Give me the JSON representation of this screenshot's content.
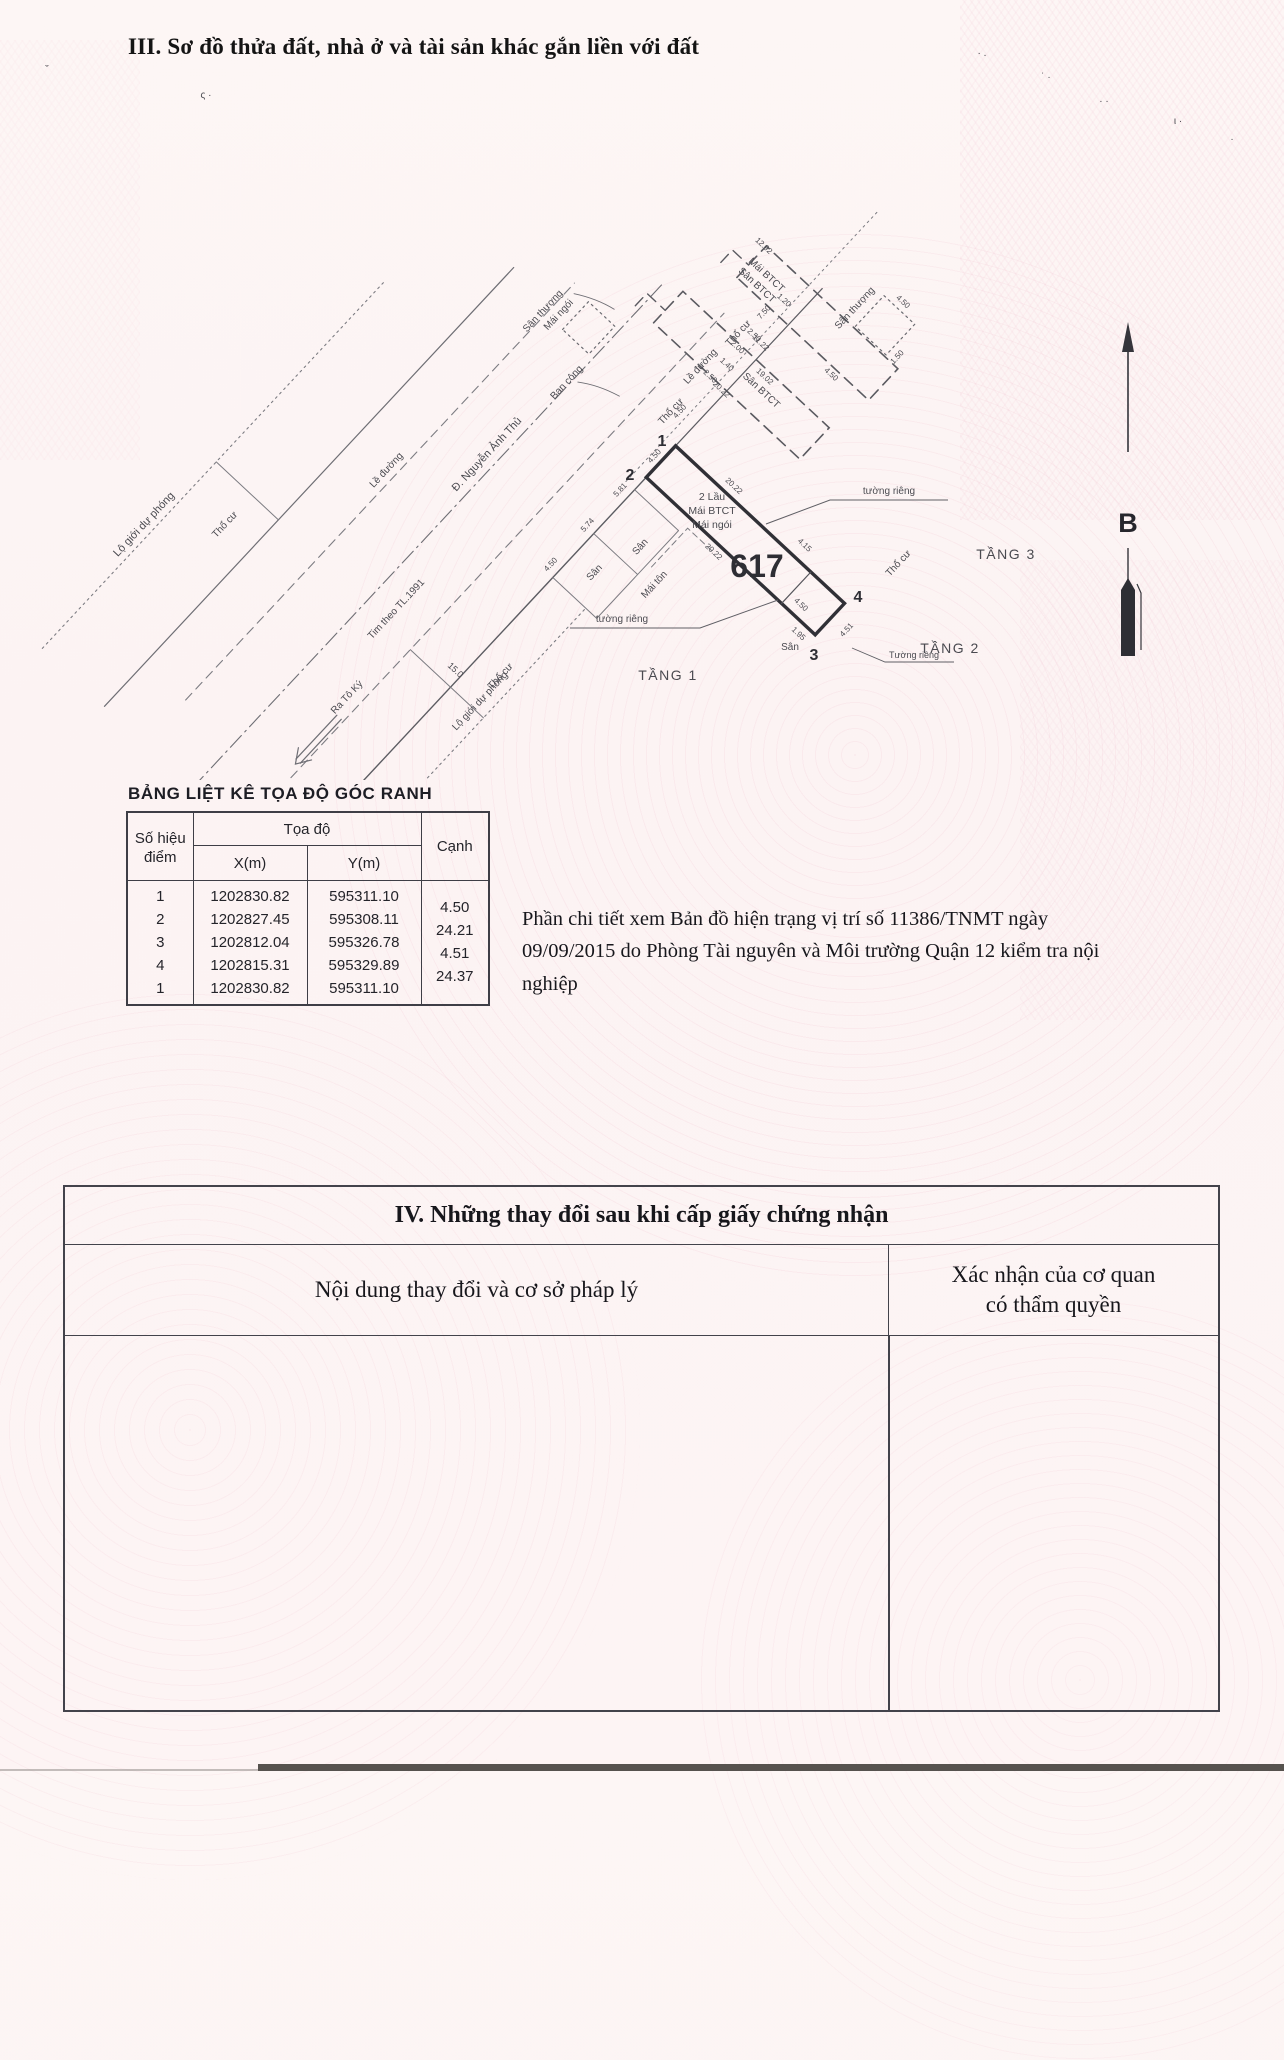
{
  "page": {
    "section3_title": "III. Sơ đồ thửa đất, nhà ở và tài sản khác gắn liền với đất",
    "note_paragraph": "Phần chi tiết xem Bản đồ hiện trạng vị trí số 11386/TNMT ngày 09/09/2015 do Phòng Tài nguyên và Môi trường Quận 12 kiểm tra nội nghiệp"
  },
  "coord_table": {
    "title": "BẢNG LIỆT KÊ TỌA ĐỘ GÓC RANH",
    "col_point_line1": "Số hiệu",
    "col_point_line2": "điểm",
    "col_coords": "Tọa độ",
    "col_x": "X(m)",
    "col_y": "Y(m)",
    "col_edge": "Cạnh",
    "rows": [
      [
        "1",
        "1202830.82",
        "595311.10"
      ],
      [
        "2",
        "1202827.45",
        "595308.11"
      ],
      [
        "3",
        "1202812.04",
        "595326.78"
      ],
      [
        "4",
        "1202815.31",
        "595329.89"
      ],
      [
        "1",
        "1202830.82",
        "595311.10"
      ]
    ],
    "edges": [
      "4.50",
      "24.21",
      "4.51",
      "24.37"
    ]
  },
  "section4": {
    "title": "IV. Những thay đổi sau khi cấp giấy chứng nhận",
    "col_left": "Nội dung thay đổi và cơ sở pháp lý",
    "col_right_line1": "Xác nhận của cơ quan",
    "col_right_line2": "có thẩm quyền"
  },
  "compass": {
    "label": "B"
  },
  "diagram": {
    "plot_number": "617",
    "labels": [
      {
        "t": "Lộ giới dự phóng",
        "x": -400,
        "y": -302,
        "s": 11,
        "n": "street-label-lo-gioi-du-phong"
      },
      {
        "t": "Thổ cư",
        "x": -345,
        "y": -243,
        "s": 10
      },
      {
        "t": "Lề đường",
        "x": -195,
        "y": -162,
        "s": 10
      },
      {
        "t": "Đ. Nguyễn Ảnh Thủ",
        "x": -115,
        "y": -99,
        "s": 11,
        "n": "street-name-label"
      },
      {
        "t": "Tim theo TL.1991",
        "x": -290,
        "y": -60,
        "s": 10
      },
      {
        "t": "Ra Tô Ký",
        "x": -388,
        "y": -36,
        "s": 10
      },
      {
        "t": "Lề đường",
        "x": 95,
        "y": -3,
        "s": 10
      },
      {
        "t": "Lộ giới dự phóng",
        "x": -300,
        "y": 64,
        "s": 10,
        "n": "street-label-lo-gioi-du-phong"
      },
      {
        "t": "15.0",
        "x": -297,
        "y": 22,
        "r": 90,
        "s": 9
      },
      {
        "t": "Thổ cư",
        "x": -268,
        "y": 62,
        "s": 10
      },
      {
        "t": "Sân",
        "x": -128,
        "y": 60,
        "s": 10
      },
      {
        "t": "Sân",
        "x": -78,
        "y": 76,
        "s": 10
      },
      {
        "t": "Mái tôn",
        "x": -96,
        "y": 112,
        "s": 10
      },
      {
        "t": "Thổ cư",
        "x": 42,
        "y": 6,
        "s": 10
      },
      {
        "t": "Thổ cư",
        "x": 145,
        "y": 2,
        "s": 10
      },
      {
        "t": "Thổ cư",
        "x": 86,
        "y": 276,
        "s": 10
      },
      {
        "t": "4.50",
        "x": -152,
        "y": 22,
        "s": 8
      },
      {
        "t": "5.74",
        "x": -98,
        "y": 22,
        "s": 8
      },
      {
        "t": "5.81",
        "x": -50,
        "y": 22,
        "s": 8
      },
      {
        "t": "4.50",
        "x": -2,
        "y": 24,
        "s": 8
      },
      {
        "t": "20.22",
        "x": -34,
        "y": 130,
        "r": 90,
        "s": 8
      },
      {
        "t": "20.22",
        "x": 28,
        "y": 100,
        "r": 90,
        "s": 8
      },
      {
        "t": "4.15",
        "x": 33,
        "y": 192,
        "r": 90,
        "s": 8
      },
      {
        "t": "4.50",
        "x": -13,
        "y": 230,
        "r": 90,
        "s": 8
      },
      {
        "t": "1.95",
        "x": -36,
        "y": 248,
        "r": 90,
        "s": 8
      },
      {
        "t": "4.51",
        "x": 2,
        "y": 283,
        "s": 8
      },
      {
        "t": "4.50",
        "x": 48,
        "y": 12,
        "s": 8
      },
      {
        "t": "2.50",
        "x": 92,
        "y": 8,
        "r": 90,
        "s": 8
      },
      {
        "t": "1.40",
        "x": 112,
        "y": 12,
        "r": 90,
        "s": 8
      },
      {
        "t": "2.00",
        "x": 132,
        "y": 8,
        "r": 90,
        "s": 8
      },
      {
        "t": "2.50",
        "x": 152,
        "y": 12,
        "r": 90,
        "s": 8
      },
      {
        "t": "7.50",
        "x": 178,
        "y": 6,
        "s": 8
      },
      {
        "t": "1.20",
        "x": 198,
        "y": 10,
        "r": 90,
        "s": 8
      },
      {
        "t": "Sân BTCT",
        "x": 116,
        "y": 55,
        "r": 90,
        "s": 10
      },
      {
        "t": "20.22",
        "x": 90,
        "y": 25,
        "r": 90,
        "s": 8
      },
      {
        "t": "19.02",
        "x": 129,
        "y": 48,
        "r": 90,
        "s": 8
      },
      {
        "t": "11.22",
        "x": 151,
        "y": 22,
        "r": 90,
        "s": 8
      },
      {
        "t": "Ban công",
        "x": -8,
        "y": -90,
        "s": 10
      },
      {
        "t": "Sân thượng",
        "x": 28,
        "y": -156,
        "s": 10
      },
      {
        "t": "Mái ngói",
        "x": 36,
        "y": -142,
        "s": 10
      },
      {
        "t": "Sân BTCT",
        "x": 190,
        "y": -20,
        "r": 90,
        "s": 10
      },
      {
        "t": "Mái BTCT",
        "x": 204,
        "y": -20,
        "r": 90,
        "s": 10
      },
      {
        "t": "12.92",
        "x": 224,
        "y": -42,
        "r": 90,
        "s": 8
      },
      {
        "t": "4.50",
        "x": 176,
        "y": 95,
        "r": 90,
        "s": 8
      },
      {
        "t": "Sân thượng",
        "x": 243,
        "y": 70,
        "s": 10
      },
      {
        "t": "1.50",
        "x": 236,
        "y": 134,
        "s": 8
      },
      {
        "t": "4.50",
        "x": 278,
        "y": 98,
        "r": 90,
        "s": 8
      },
      {
        "f": "s",
        "t": "1",
        "x": 662,
        "y": 446,
        "b": 1,
        "s": 16,
        "n": "vertex-1-label"
      },
      {
        "f": "s",
        "t": "2",
        "x": 630,
        "y": 480,
        "b": 1,
        "s": 16,
        "n": "vertex-2-label"
      },
      {
        "f": "s",
        "t": "3",
        "x": 814,
        "y": 660,
        "b": 1,
        "s": 16,
        "n": "vertex-3-label"
      },
      {
        "f": "s",
        "t": "4",
        "x": 858,
        "y": 602,
        "b": 1,
        "s": 16,
        "n": "vertex-4-label"
      },
      {
        "f": "s",
        "t": "2 Lầu",
        "x": 712,
        "y": 500,
        "s": 10.5
      },
      {
        "f": "s",
        "t": "Mái BTCT",
        "x": 712,
        "y": 514,
        "s": 10.5
      },
      {
        "f": "s",
        "t": "Mái ngói",
        "x": 712,
        "y": 528,
        "s": 10.5
      },
      {
        "f": "s",
        "t": "617",
        "x": 757,
        "y": 577,
        "b": 1,
        "s": 32,
        "n": "plot-number-label"
      },
      {
        "f": "s",
        "t": "tường riêng",
        "x": 889,
        "y": 494,
        "s": 10
      },
      {
        "f": "s",
        "t": "tường riêng",
        "x": 622,
        "y": 622,
        "s": 10
      },
      {
        "f": "s",
        "t": "Tường riêng",
        "x": 914,
        "y": 658,
        "s": 9
      },
      {
        "f": "s",
        "t": "Sân",
        "x": 790,
        "y": 650,
        "s": 10
      },
      {
        "f": "s",
        "t": "TẦNG 1",
        "x": 668,
        "y": 680,
        "s": 14,
        "sp": 1.5,
        "n": "floor-label-1"
      },
      {
        "f": "s",
        "t": "TẦNG 2",
        "x": 950,
        "y": 653,
        "s": 14,
        "sp": 1.5,
        "n": "floor-label-2"
      },
      {
        "f": "s",
        "t": "TẦNG 3",
        "x": 1006,
        "y": 559,
        "s": 14,
        "sp": 1.5,
        "n": "floor-label-3"
      },
      {
        "f": "s",
        "t": "ˬ",
        "x": 47,
        "y": 64,
        "s": 11,
        "c": "#8d8389"
      },
      {
        "f": "s",
        "t": "ς ·",
        "x": 206,
        "y": 98,
        "s": 10,
        "c": "#8d8389"
      },
      {
        "f": "s",
        "t": "· .",
        "x": 982,
        "y": 56,
        "s": 10,
        "c": "#9a8f94"
      },
      {
        "f": "s",
        "t": "˙ ·",
        "x": 1046,
        "y": 80,
        "s": 10,
        "c": "#9a8f94"
      },
      {
        "f": "s",
        "t": "· ·",
        "x": 1104,
        "y": 104,
        "s": 10,
        "c": "#9a8f94"
      },
      {
        "f": "s",
        "t": "ι ·",
        "x": 1178,
        "y": 124,
        "s": 10,
        "c": "#9a8f94"
      },
      {
        "f": "s",
        "t": "·",
        "x": 1232,
        "y": 142,
        "s": 10,
        "c": "#9a8f94"
      }
    ]
  }
}
